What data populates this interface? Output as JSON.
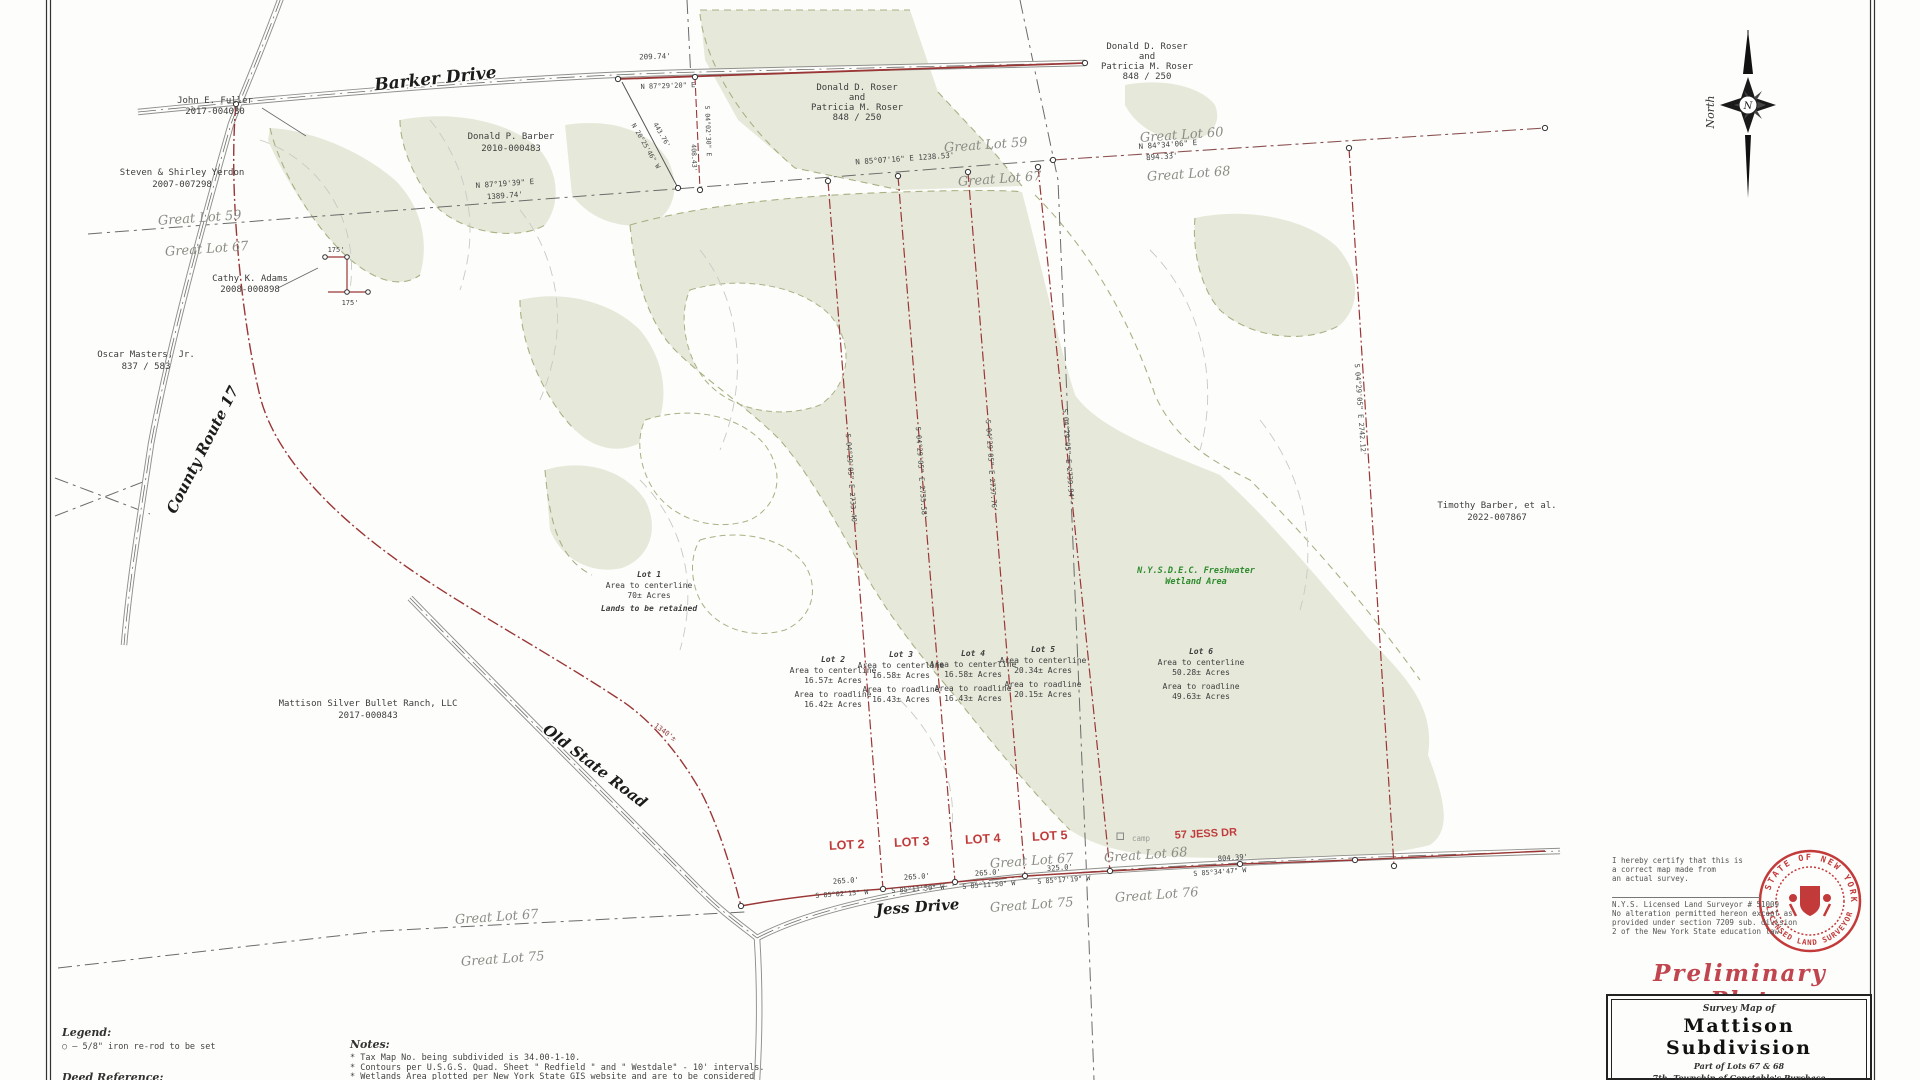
{
  "map": {
    "roads": {
      "barker": "Barker Drive",
      "county17": "County Route 17",
      "old_state": "Old State Road",
      "jess": "Jess Drive"
    },
    "compass": {
      "word": "North",
      "letter": "N"
    },
    "owners": {
      "fuller1": "John E. Fuller",
      "fuller2": "2017-004030",
      "yerdon1": "Steven & Shirley Yerdon",
      "yerdon2": "2007-007298",
      "barber1": "Donald P. Barber",
      "barber2": "2010-000483",
      "roser1": "Donald D. Roser",
      "roser2": "and",
      "roser3": "Patricia M. Roser",
      "roser4": "848 / 250",
      "adams1": "Cathy K. Adams",
      "adams2": "2008-000898",
      "masters1": "Oscar Masters, Jr.",
      "masters2": "837 / 583",
      "mattison1": "Mattison Silver Bullet Ranch, LLC",
      "mattison2": "2017-000843",
      "tbarber1": "Timothy Barber, et al.",
      "tbarber2": "2022-007867"
    },
    "great_lots": {
      "gl59": "Great Lot 59",
      "gl60": "Great Lot 60",
      "gl67": "Great Lot 67",
      "gl68": "Great Lot 68",
      "gl75": "Great Lot 75",
      "gl76": "Great Lot 76"
    },
    "lots": {
      "area_cl": "Area to centerline",
      "area_rl": "Area to roadline",
      "lot1_title": "Lot 1",
      "lot1_acres": "70± Acres",
      "lot1_note": "Lands to be retained",
      "lot2_title": "Lot 2",
      "lot2_cl": "16.57± Acres",
      "lot2_rl": "16.42± Acres",
      "lot3_title": "Lot 3",
      "lot3_cl": "16.58± Acres",
      "lot3_rl": "16.43± Acres",
      "lot4_title": "Lot 4",
      "lot4_cl": "16.58± Acres",
      "lot4_rl": "16.43± Acres",
      "lot5_title": "Lot 5",
      "lot5_cl": "20.34± Acres",
      "lot5_rl": "20.15± Acres",
      "lot6_title": "Lot 6",
      "lot6_cl": "50.28± Acres",
      "lot6_rl": "49.63± Acres"
    },
    "frontage": {
      "f1": "LOT 2",
      "f2": "LOT 3",
      "f3": "LOT 4",
      "f4": "LOT 5",
      "f5": "57 JESS DR",
      "camp": "camp"
    },
    "wetland": {
      "l1": "N.Y.S.D.E.C. Freshwater",
      "l2": "Wetland Area"
    },
    "bearings": {
      "barker_d": "209.74'",
      "barker_b": "N 87°29'20\" E",
      "gl1_b": "N 87°19'39\" E",
      "gl1_d": "1389.74'",
      "gl2_bd": "N 85°07'16\" E   1238.53'",
      "gl3_b": "N 84°34'06\" E",
      "gl3_d": "894.33'",
      "diag_d": "443.76'",
      "diag_b": "N 20°25'46\" W",
      "east_b": "S 04°02'30\" E",
      "east_d": "408.43'",
      "ll1": "S 04°29'05\" E   2733.40'",
      "ll2": "S 04°29'05\" E   2735.58'",
      "ll3": "S 04°29'05\" E   2737.76'",
      "ll4": "S 04°29'05\" E   2739.94'",
      "far": "S 04°29'05\" E   2742.12'"
    },
    "jess_dims": {
      "d1": "265.0'",
      "d2": "265.0'",
      "d3": "265.0'",
      "d4": "325.0'",
      "d5": "804.39'",
      "b1": "S 85°02'15\" W",
      "b2": "S 85°11'50\" W",
      "b3": "S 85°11'50\" W",
      "b4": "S 85°17'19\" W",
      "b5": "S 85°34'47\" W"
    },
    "misc": {
      "m1340": "1340'±",
      "m175a": "175'",
      "m175b": "175'"
    }
  },
  "legend": {
    "title": "Legend:",
    "iron": "○ — 5/8\" iron re-rod to be set",
    "deed": "Deed Reference:"
  },
  "notes": {
    "title": "Notes:",
    "n1": "* Tax Map No. being subdivided is 34.00-1-10.",
    "n2": "* Contours per U.S.G.S. Quad. Sheet \" Redfield \" and \" Westdale\" - 10' intervals.",
    "n3": "* Wetlands Area plotted per New York State GIS website and are to be considered"
  },
  "certification": {
    "c1": "I hereby certify that this is",
    "c2": "a correct map made from",
    "c3": "an actual survey.",
    "surveyor": "N.Y.S. Licensed Land Surveyor # 51009",
    "a1": "No alteration permitted hereon except as",
    "a2": "provided under section 7209 sub. division",
    "a3": "2 of the New York State education law."
  },
  "seal": {
    "arc_top": "STATE OF NEW YORK",
    "arc_bottom": "LICENSED LAND SURVEYOR"
  },
  "stamp": "Preliminary Plat",
  "title_block": {
    "kicker": "Survey Map of",
    "title": "Mattison Subdivision",
    "part": "Part of Lots 67 & 68",
    "township": "7th. Township of Constable's Purchase",
    "town": "Town of Redfield",
    "county": "Oswego County, New York"
  }
}
